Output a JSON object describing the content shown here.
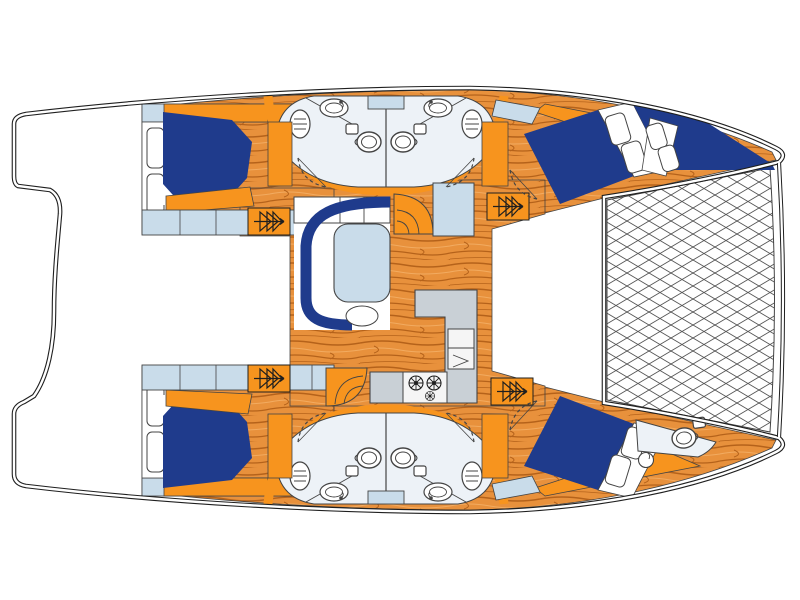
{
  "document": {
    "title": "Catamaran yacht deck plan",
    "description": "Top-down floor plan of a sailing catamaran, bow to the right: four guest cabins with double berths, four midship heads, forward crew head, forepeak berth, central saloon with settee and table, galley with sink and stove, companionway steps and bow trampoline net"
  },
  "palette": {
    "white": "#ffffff",
    "navy": "#1f3b8c",
    "orange": "#f7941e",
    "wood_base": "#e8913c",
    "wood_grain": "#b5621a",
    "wood_grain_light": "#f2ab60",
    "light_blue": "#c9dcea",
    "pale_blue": "#edf2f7",
    "counter_gray": "#c9d0d6",
    "appliance_white": "#f5f5f5",
    "line": "#1f1f1f",
    "soft_line": "#444444",
    "net_line": "#555555"
  },
  "vessel": {
    "type": "sailing catamaran",
    "orientation": "bow-right",
    "areas": [
      "port aft cabin with double berth",
      "port heads x2 (toilet, basin, porthole)",
      "port forward cabin with angled double berth",
      "forepeak berth (port bow)",
      "starboard aft cabin with double berth",
      "starboard heads x2 (toilet, basin, porthole)",
      "starboard forward cabin with angled double berth",
      "forward crew head (starboard bow)",
      "saloon with C-settee, table and stool",
      "galley with L-counter, sink and 3-burner stove",
      "bow trampoline net",
      "aft cockpit and swim platforms"
    ]
  },
  "icons": {
    "steps": "companionway-steps-glyph",
    "door": "dashed-door-swing-arc",
    "toilet": "toilet-bowl-with-cistern",
    "basin": "oval-basin-with-tap",
    "porthole": "lined-oval-porthole",
    "burner": "stove-burner-ring",
    "net": "diamond-crosshatch-trampoline"
  }
}
